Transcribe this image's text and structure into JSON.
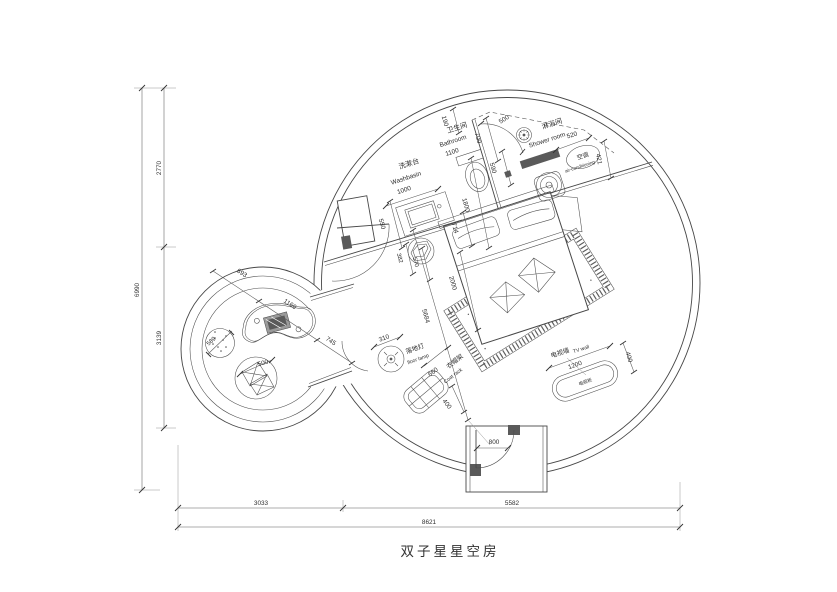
{
  "title": "双子星星空房",
  "rooms": {
    "washbasin": {
      "cn": "洗漱台",
      "en": "Washbasin",
      "dim": "1000"
    },
    "bathroom": {
      "cn": "卫生间",
      "en": "Bathroom",
      "dim": "1100"
    },
    "shower": {
      "cn": "淋浴间",
      "en": "Shower room"
    },
    "ac": {
      "cn": "空调",
      "en": "air-conditioning"
    },
    "floor_lamp": {
      "cn": "落地灯",
      "en": "floor lamp",
      "dim": "310"
    },
    "coat_rack": {
      "cn": "衣帽架",
      "en": "Coat rack",
      "w": "660",
      "h": "400"
    },
    "tv_wall": {
      "cn": "电视墙",
      "en": "TV wall",
      "w": "1200",
      "h": "400",
      "cabinet": "电视柜"
    }
  },
  "dims": {
    "bath_190": "190",
    "bath_700": "700",
    "shower_500": "500",
    "shower_590": "590",
    "bench_520": "520",
    "ac_421": "421",
    "basin_550": "550",
    "toilet_714": "714",
    "bed_w": "1800",
    "bed_l": "2000",
    "room_diag": "5684",
    "table_382": "382",
    "table_570": "570",
    "door_800": "800",
    "pod_693": "693",
    "pod_1166": "1166",
    "pod_745": "745",
    "stool_589": "589",
    "chair_500": "500",
    "left_total": "6990",
    "left_top": "2770",
    "left_mid": "3139",
    "bottom_left": "3033",
    "bottom_right": "5582",
    "bottom_total": "8621"
  }
}
